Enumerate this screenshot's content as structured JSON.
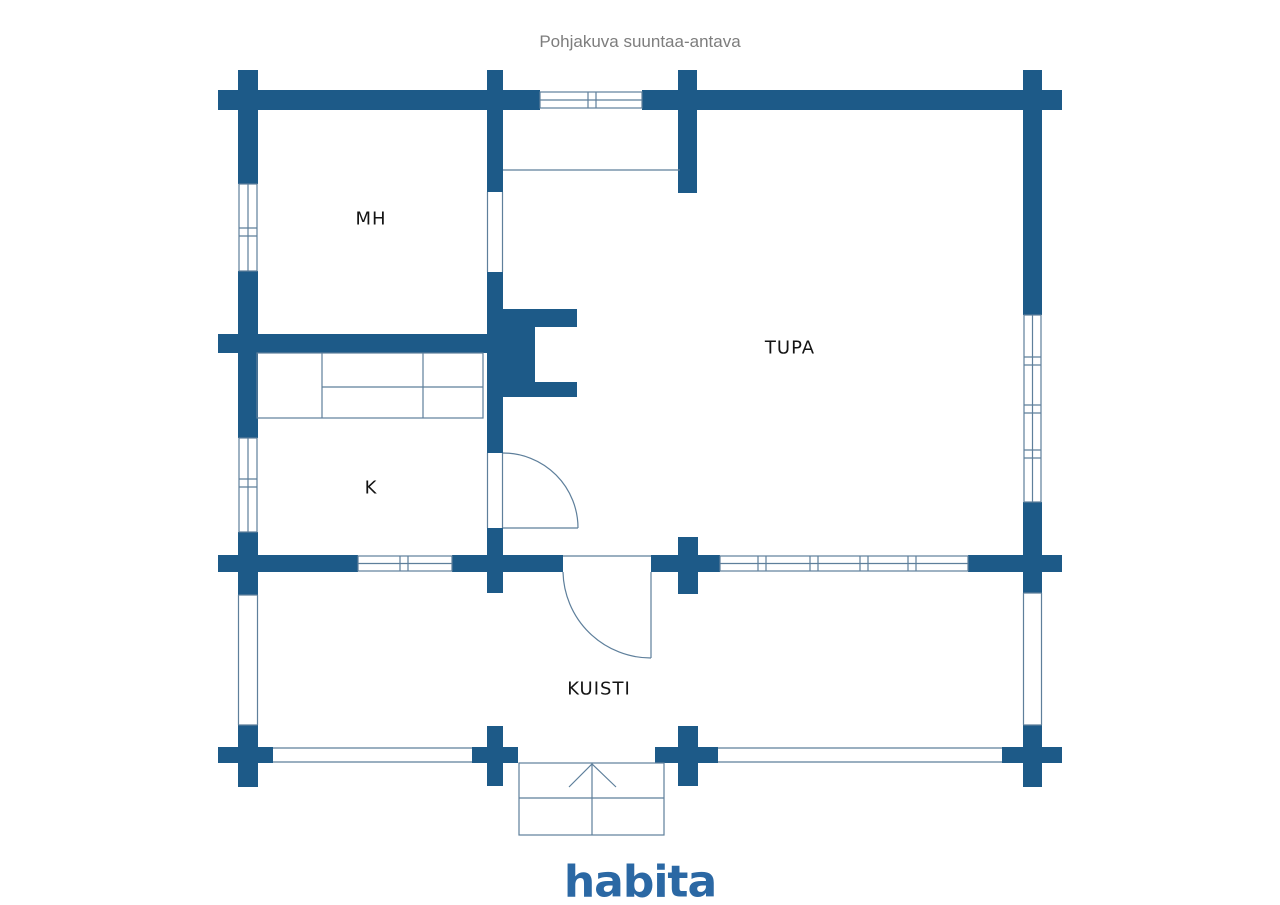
{
  "title": "Pohjakuva suuntaa-antava",
  "rooms": {
    "mh": {
      "label": "MH"
    },
    "tupa": {
      "label": "TUPA"
    },
    "k": {
      "label": "K"
    },
    "kuisti": {
      "label": "KUISTI"
    }
  },
  "branding": {
    "logo_text": "habita"
  },
  "colors": {
    "wall": "#1d5a88",
    "line": "#5e7f9b",
    "background": "#ffffff",
    "title_text": "#7d7d7d",
    "label_text": "#141414",
    "logo": "#2b68a4"
  }
}
